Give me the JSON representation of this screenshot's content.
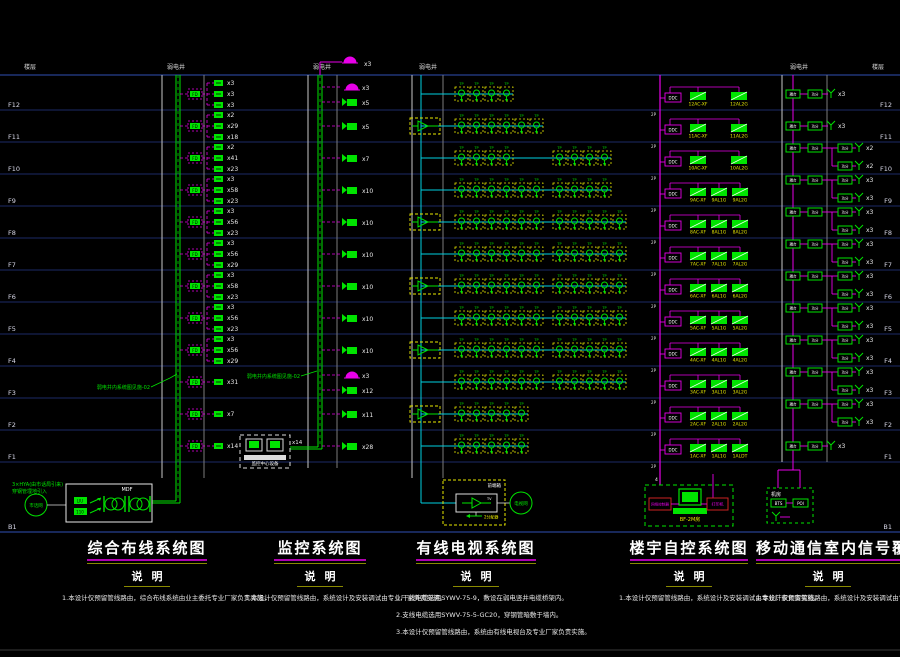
{
  "colors": {
    "background": "#000000",
    "floor_line": "#1b2a66",
    "frame_line": "#27408f",
    "grid_white": "#c9c9c9",
    "grid_gray": "#7d7d7d",
    "green": "#00e400",
    "magenta": "#e800e8",
    "cyan": "#00cfe0",
    "yellow": "#e8e800",
    "red": "#cc2222",
    "white_text": "#e8e8e8"
  },
  "header": {
    "floor_col_label": "楼层",
    "shaft_label": "弱电井"
  },
  "basement_label": "B1",
  "roof": {
    "cctv_dome_count": "x3"
  },
  "floors": [
    {
      "id": "F12",
      "cabling": [
        "x3",
        "x3",
        "x3"
      ],
      "cctv": [
        {
          "icon": "dome",
          "count": "x3"
        },
        {
          "icon": "camera",
          "count": "x5"
        }
      ],
      "tv": {
        "amp": false,
        "chains": [
          4
        ]
      },
      "ba": [
        "12AC-XF",
        "12AL2G"
      ],
      "mobile": [
        "x3"
      ]
    },
    {
      "id": "F11",
      "cabling": [
        "x2",
        "x29",
        "x18"
      ],
      "cctv": [
        {
          "icon": "camera",
          "count": "x5"
        }
      ],
      "tv": {
        "amp": true,
        "chains": [
          6
        ]
      },
      "ba": [
        "11AC-XF",
        "11AL2G"
      ],
      "mobile": [
        "x3"
      ]
    },
    {
      "id": "F10",
      "cabling": [
        "x2",
        "x41",
        "x23"
      ],
      "cctv": [
        {
          "icon": "camera",
          "count": "x7"
        }
      ],
      "tv": {
        "amp": false,
        "chains": [
          4,
          4
        ]
      },
      "ba": [
        "10AC-XF",
        "10AL2G"
      ],
      "mobile": [
        "x2",
        "x2"
      ]
    },
    {
      "id": "F9",
      "cabling": [
        "x3",
        "x58",
        "x23"
      ],
      "cctv": [
        {
          "icon": "camera",
          "count": "x10"
        }
      ],
      "tv": {
        "amp": false,
        "chains": [
          6,
          4
        ]
      },
      "ba": [
        "9AC-XF",
        "9AL1G",
        "9AL2G"
      ],
      "mobile": [
        "x3",
        "x3"
      ]
    },
    {
      "id": "F8",
      "cabling": [
        "x3",
        "x56",
        "x23"
      ],
      "cctv": [
        {
          "icon": "camera",
          "count": "x10"
        }
      ],
      "tv": {
        "amp": true,
        "chains": [
          6,
          5
        ]
      },
      "ba": [
        "8AC-XF",
        "8AL1G",
        "8AL2G"
      ],
      "mobile": [
        "x3",
        "x3"
      ]
    },
    {
      "id": "F7",
      "cabling": [
        "x3",
        "x56",
        "x29"
      ],
      "cctv": [
        {
          "icon": "camera",
          "count": "x10"
        }
      ],
      "tv": {
        "amp": false,
        "chains": [
          6,
          5
        ]
      },
      "ba": [
        "7AC-XF",
        "7AL1G",
        "7AL2G"
      ],
      "mobile": [
        "x3",
        "x3"
      ]
    },
    {
      "id": "F6",
      "cabling": [
        "x3",
        "x58",
        "x23"
      ],
      "cctv": [
        {
          "icon": "camera",
          "count": "x10"
        }
      ],
      "tv": {
        "amp": true,
        "chains": [
          6,
          5
        ]
      },
      "ba": [
        "6AC-XF",
        "6AL1G",
        "6AL2G"
      ],
      "mobile": [
        "x3",
        "x3"
      ]
    },
    {
      "id": "F5",
      "cabling": [
        "x3",
        "x56",
        "x23"
      ],
      "cctv": [
        {
          "icon": "camera",
          "count": "x10"
        }
      ],
      "tv": {
        "amp": false,
        "chains": [
          6,
          5
        ]
      },
      "ba": [
        "5AC-XF",
        "5AL1G",
        "5AL2G"
      ],
      "mobile": [
        "x3",
        "x3"
      ]
    },
    {
      "id": "F4",
      "cabling": [
        "x3",
        "x56",
        "x29"
      ],
      "cctv": [
        {
          "icon": "camera",
          "count": "x10"
        }
      ],
      "tv": {
        "amp": true,
        "chains": [
          6,
          5
        ]
      },
      "ba": [
        "4AC-XF",
        "4AL1G",
        "4AL2G"
      ],
      "mobile": [
        "x3",
        "x3"
      ]
    },
    {
      "id": "F3",
      "cabling": [
        "x31"
      ],
      "cctv": [
        {
          "icon": "dome",
          "count": "x3"
        },
        {
          "icon": "camera",
          "count": "x12"
        }
      ],
      "tv": {
        "amp": false,
        "chains": [
          6,
          5
        ]
      },
      "ba": [
        "3AC-XF",
        "3AL1G",
        "3AL2G"
      ],
      "mobile": [
        "x3",
        "x3"
      ]
    },
    {
      "id": "F2",
      "cabling": [
        "x7"
      ],
      "cctv": [
        {
          "icon": "camera",
          "count": "x11"
        }
      ],
      "tv": {
        "amp": true,
        "chains": [
          5
        ]
      },
      "ba": [
        "2AC-XF",
        "2AL1G",
        "2AL2G"
      ],
      "mobile": [
        "x3",
        "x3"
      ]
    },
    {
      "id": "F1",
      "cabling": [
        "x14"
      ],
      "cctv": [
        {
          "icon": "camera",
          "count": "x28"
        }
      ],
      "tv": {
        "amp": false,
        "chains": [
          5
        ]
      },
      "ba": [
        "1AC-XF",
        "1AL1G",
        "1ALDT"
      ],
      "mobile": [
        "x3"
      ]
    }
  ],
  "cabling": {
    "fd_label": "FD",
    "annotation": "弱电井内系统图见施-02",
    "incoming_note_l1": "3×HYA(由市话局引来)",
    "incoming_note_l2": "穿钢管埋地引入",
    "network_circle": "市话网",
    "mdf_label": "MDF",
    "liu_label": "LIU",
    "v110_label": "110"
  },
  "cctv": {
    "annotation": "弱电井内系统图见施-02",
    "control_room_label": "监控中心设备",
    "aux_label": "x14"
  },
  "tv": {
    "tap_label": "TP",
    "headend_label": "前端箱",
    "amp_tag": "TV",
    "network_circle": "电视网",
    "splitter_label": "2分配器"
  },
  "ba": {
    "ddc_label": "DDC",
    "riser_tick": "2P",
    "computer_room": {
      "left_box": "网络控制器",
      "right_box": "打印机",
      "location": "BF-2M房",
      "drop_count": "4"
    }
  },
  "mobile": {
    "coupler_label": "耦合",
    "splitter_label": "功分",
    "room_label": "机房",
    "bts_label": "BTS",
    "poi_label": "POI"
  },
  "titles": [
    {
      "title": "综合布线系统图",
      "notes_heading": "说明",
      "notes": [
        "1.本设计仅预留管线路由，综合布线系统由业主委托专业厂家负责实施。"
      ]
    },
    {
      "title": "监控系统图",
      "notes_heading": "说明",
      "notes": [
        "1.本设计仅预留管线路由，系统设计及安装调试由专业厂家负责实施。"
      ]
    },
    {
      "title": "有线电视系统图",
      "notes_heading": "说明",
      "notes": [
        "1.干线电缆选用SYWV-75-9，敷设在弱电竖井电缆桥架内。",
        "2.支线电缆选用SYWV-75-5-GC20，穿钢管暗敷于墙内。",
        "3.本设计仅预留管线路由，系统由有线电视台及专业厂家负责实施。"
      ]
    },
    {
      "title": "楼宇自控系统图",
      "notes_heading": "说明",
      "notes": [
        "1.本设计仅预留管线路由，系统设计及安装调试由专业厂家负责实施。"
      ]
    },
    {
      "title": "移动通信室内信号覆盖系统",
      "notes_heading": "说明",
      "notes": [
        "1.本设计仅预留管线路由，系统设计及安装调试由专业厂家负责实施。"
      ]
    }
  ]
}
